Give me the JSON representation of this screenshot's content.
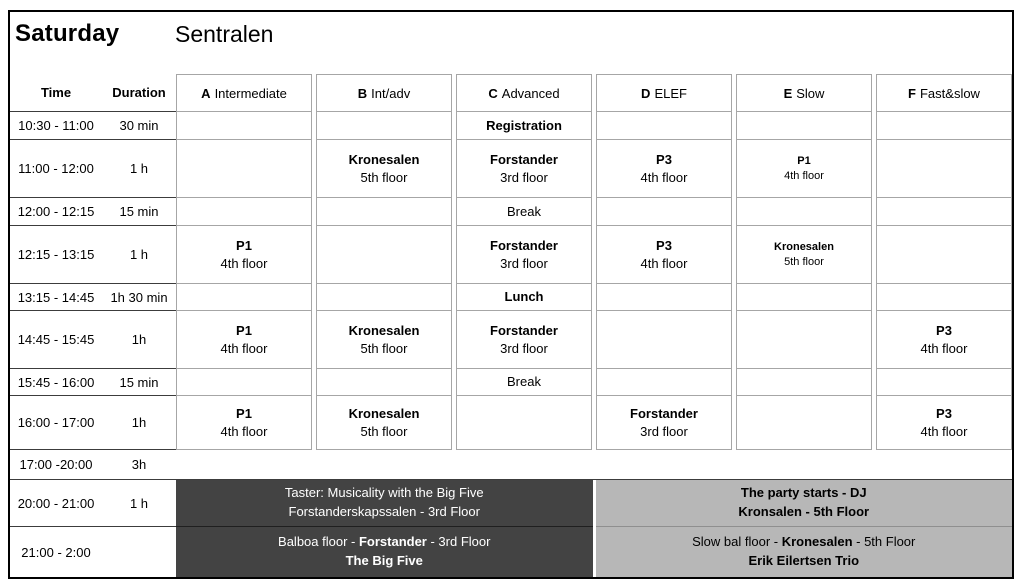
{
  "title": {
    "day": "Saturday",
    "venue": "Sentralen"
  },
  "time_header": "Time",
  "duration_header": "Duration",
  "columns": [
    {
      "letter": "A",
      "label": "Intermediate"
    },
    {
      "letter": "B",
      "label": "Int/adv"
    },
    {
      "letter": "C",
      "label": "Advanced"
    },
    {
      "letter": "D",
      "label": "ELEF"
    },
    {
      "letter": "E",
      "label": "Slow"
    },
    {
      "letter": "F",
      "label": "Fast&slow"
    }
  ],
  "rows": [
    {
      "time": "10:30 - 11:00",
      "duration": "30 min",
      "height": 28,
      "cells": [
        null,
        null,
        {
          "line1": "Registration"
        },
        null,
        null,
        null
      ]
    },
    {
      "time": "11:00 - 12:00",
      "duration": "1 h",
      "height": 58,
      "cells": [
        null,
        {
          "line1": "Kronesalen",
          "line2": "5th floor"
        },
        {
          "line1": "Forstander",
          "line2": "3rd floor"
        },
        {
          "line1": "P3",
          "line2": "4th floor"
        },
        {
          "line1": "P1",
          "line2": "4th floor",
          "small": true
        },
        null
      ]
    },
    {
      "time": "12:00 - 12:15",
      "duration": "15 min",
      "height": 28,
      "cells": [
        null,
        null,
        {
          "line1": "Break",
          "plain": true
        },
        null,
        null,
        null
      ]
    },
    {
      "time": "12:15 - 13:15",
      "duration": "1 h",
      "height": 58,
      "cells": [
        {
          "line1": "P1",
          "line2": "4th floor"
        },
        null,
        {
          "line1": "Forstander",
          "line2": "3rd floor"
        },
        {
          "line1": "P3",
          "line2": "4th floor"
        },
        {
          "line1": "Kronesalen",
          "line2": "5th floor",
          "small": true
        },
        null
      ]
    },
    {
      "time": "13:15 - 14:45",
      "duration": "1h 30 min",
      "height": 27,
      "cells": [
        null,
        null,
        {
          "line1": "Lunch"
        },
        null,
        null,
        null
      ]
    },
    {
      "time": "14:45 - 15:45",
      "duration": "1h",
      "height": 58,
      "cells": [
        {
          "line1": "P1",
          "line2": "4th floor"
        },
        {
          "line1": "Kronesalen",
          "line2": "5th floor"
        },
        {
          "line1": "Forstander",
          "line2": "3rd floor"
        },
        null,
        null,
        {
          "line1": "P3",
          "line2": "4th floor"
        }
      ]
    },
    {
      "time": "15:45 - 16:00",
      "duration": "15 min",
      "height": 27,
      "cells": [
        null,
        null,
        {
          "line1": "Break",
          "plain": true
        },
        null,
        null,
        null
      ]
    },
    {
      "time": "16:00 - 17:00",
      "duration": "1h",
      "height": 54,
      "cells": [
        {
          "line1": "P1",
          "line2": "4th floor"
        },
        {
          "line1": "Kronesalen",
          "line2": "5th floor"
        },
        null,
        {
          "line1": "Forstander",
          "line2": "3rd floor"
        },
        null,
        {
          "line1": "P3",
          "line2": "4th floor"
        }
      ]
    }
  ],
  "spanning_rows": [
    {
      "time": "17:00 -20:00",
      "duration": "3h",
      "height": 30,
      "type": "empty"
    },
    {
      "time": "20:00 - 21:00",
      "duration": "1 h",
      "height": 47,
      "type": "party",
      "left": {
        "lines": [
          [
            {
              "t": "Taster: Musicality with the Big Five"
            }
          ],
          [
            {
              "t": "Forstanderskapssalen - 3rd Floor"
            }
          ]
        ]
      },
      "right": {
        "lines": [
          [
            {
              "t": "The party starts - DJ",
              "b": true
            }
          ],
          [
            {
              "t": "Kronsalen - 5th Floor",
              "b": true
            }
          ]
        ]
      }
    },
    {
      "time": "21:00 - 2:00",
      "duration": "",
      "height": 50,
      "type": "party",
      "left": {
        "lines": [
          [
            {
              "t": "Balboa floor - "
            },
            {
              "t": "Forstander",
              "b": true
            },
            {
              "t": " - 3rd Floor"
            }
          ],
          [
            {
              "t": "The Big Five",
              "b": true
            }
          ]
        ]
      },
      "right": {
        "lines": [
          [
            {
              "t": "Slow bal floor - "
            },
            {
              "t": "Kronesalen",
              "b": true
            },
            {
              "t": " - 5th Floor"
            }
          ],
          [
            {
              "t": "Erik Eilertsen Trio",
              "b": true
            }
          ]
        ]
      }
    }
  ],
  "colors": {
    "dark_band": "#434343",
    "light_band": "#b7b7b7",
    "grid_line": "#a6a6a6",
    "section_line": "#3c3c3c",
    "outer_border": "#000000"
  }
}
